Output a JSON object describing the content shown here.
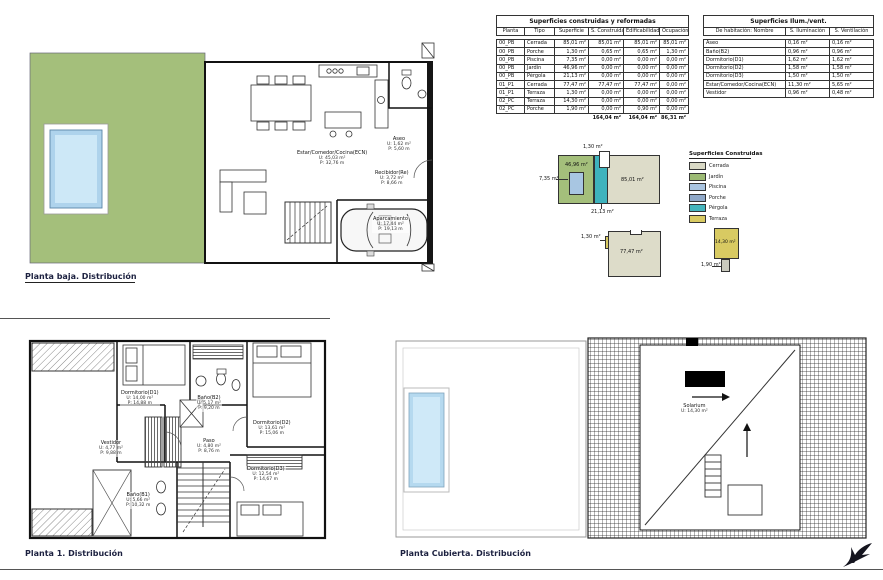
{
  "sheet": {
    "titles": {
      "ground": "Planta baja. Distribución",
      "first": "Planta 1. Distribución",
      "roof": "Planta Cubierta. Distribución"
    }
  },
  "tables": {
    "construidas": {
      "title": "Superficies construidas y reformadas",
      "columns": [
        "Planta",
        "Tipo",
        "Superficie",
        "S. Construida",
        "Edificabilidad",
        "Ocupación"
      ],
      "rows": [
        [
          "00_PB",
          "Cerrada",
          "85,01 m²",
          "85,01 m²",
          "85,01 m²",
          "85,01 m²"
        ],
        [
          "00_PB",
          "Porche",
          "1,30 m²",
          "0,65 m²",
          "0,65 m²",
          "1,30 m²"
        ],
        [
          "00_PB",
          "Piscina",
          "7,35 m²",
          "0,00 m²",
          "0,00 m²",
          "0,00 m²"
        ],
        [
          "00_PB",
          "Jardín",
          "46,96 m²",
          "0,00 m²",
          "0,00 m²",
          "0,00 m²"
        ],
        [
          "00_PB",
          "Pérgola",
          "21,13 m²",
          "0,00 m²",
          "0,00 m²",
          "0,00 m²"
        ],
        [
          "01_P1",
          "Cerrada",
          "77,47 m²",
          "77,47 m²",
          "77,47 m²",
          "0,00 m²"
        ],
        [
          "01_P1",
          "Terraza",
          "1,30 m²",
          "0,00 m²",
          "0,00 m²",
          "0,00 m²"
        ],
        [
          "02_PC",
          "Terraza",
          "14,30 m²",
          "0,00 m²",
          "0,00 m²",
          "0,00 m²"
        ],
        [
          "02_PC",
          "Porche",
          "1,90 m²",
          "0,00 m²",
          "0,90 m²",
          "0,00 m²"
        ]
      ],
      "totals": {
        "s_construida": "164,04 m²",
        "edificabilidad": "164,04 m²",
        "ocupacion": "86,31 m²"
      }
    },
    "ilum_vent": {
      "title": "Superficies Ilum./vent.",
      "columns": [
        "De habitación: Nombre",
        "S. Iluminación",
        "S. Ventilación"
      ],
      "rows": [
        [
          "Aseo",
          "0,16 m²",
          "0,16 m²"
        ],
        [
          "Baño(B2)",
          "0,96 m²",
          "0,96 m²"
        ],
        [
          "Dormitorio(D1)",
          "1,62 m²",
          "1,62 m²"
        ],
        [
          "Dormitorio(D2)",
          "1,58 m²",
          "1,58 m²"
        ],
        [
          "Dormitorio(D3)",
          "1,50 m²",
          "1,50 m²"
        ],
        [
          "Estar/Comedor/Cocina(ECN)",
          "11,30 m²",
          "5,65 m²"
        ],
        [
          "Vestidor",
          "0,96 m²",
          "0,48 m²"
        ]
      ]
    }
  },
  "legend": {
    "title": "Superficies Construidas",
    "items": [
      {
        "label": "Cerrada",
        "color": "#d9d9c5"
      },
      {
        "label": "Jardín",
        "color": "#9cba74"
      },
      {
        "label": "Piscina",
        "color": "#a9c4e0"
      },
      {
        "label": "Porche",
        "color": "#8fa8c8"
      },
      {
        "label": "Pérgola",
        "color": "#45b5bd"
      },
      {
        "label": "Terraza",
        "color": "#d8ca62"
      }
    ]
  },
  "diagrams": {
    "pb": {
      "porche": "1,30 m²",
      "piscina": "7,35 m²",
      "jardin": "46,96 m²",
      "cerrada": "85,01 m²",
      "pergola": "21,13 m²"
    },
    "p1": {
      "terraza": "1,30 m²",
      "cerrada": "77,47 m²"
    },
    "pc": {
      "terraza": "14,30 m²",
      "porche": "1,90 m²"
    }
  },
  "rooms": {
    "ground": [
      {
        "name": "Estar/Comedor/Cocina(ECN)",
        "u": "U: 45,03 m²",
        "p": "P: 32,76 m"
      },
      {
        "name": "Aseo",
        "u": "U: 1,62 m²",
        "p": "P: 5,60 m"
      },
      {
        "name": "Recibidor(Re)",
        "u": "U: 3,72 m²",
        "p": "P: 8,66 m"
      },
      {
        "name": "Aparcamiento",
        "u": "U: 17,44 m²",
        "p": "P: 19,13 m"
      }
    ],
    "first": [
      {
        "name": "Dormitorio(D1)",
        "u": "U: 14,00 m²",
        "p": "P: 14,88 m"
      },
      {
        "name": "Baño(B2)",
        "u": "U: 5,17 m²",
        "p": "P: 9,20 m"
      },
      {
        "name": "Dormitorio(D2)",
        "u": "U: 13,61 m²",
        "p": "P: 15,06 m"
      },
      {
        "name": "Vestidor",
        "u": "U: 4,77 m²",
        "p": "P: 9,88 m"
      },
      {
        "name": "Paso",
        "u": "U: 4,80 m²",
        "p": "P: 8,76 m"
      },
      {
        "name": "Dormitorio(D3)",
        "u": "U: 12,54 m²",
        "p": "P: 14,67 m"
      },
      {
        "name": "Baño(B1)",
        "u": "U: 5,66 m²",
        "p": "P: 10,32 m"
      }
    ],
    "roof": [
      {
        "name": "Solarium",
        "u": "U: 14,30 m²"
      }
    ]
  }
}
